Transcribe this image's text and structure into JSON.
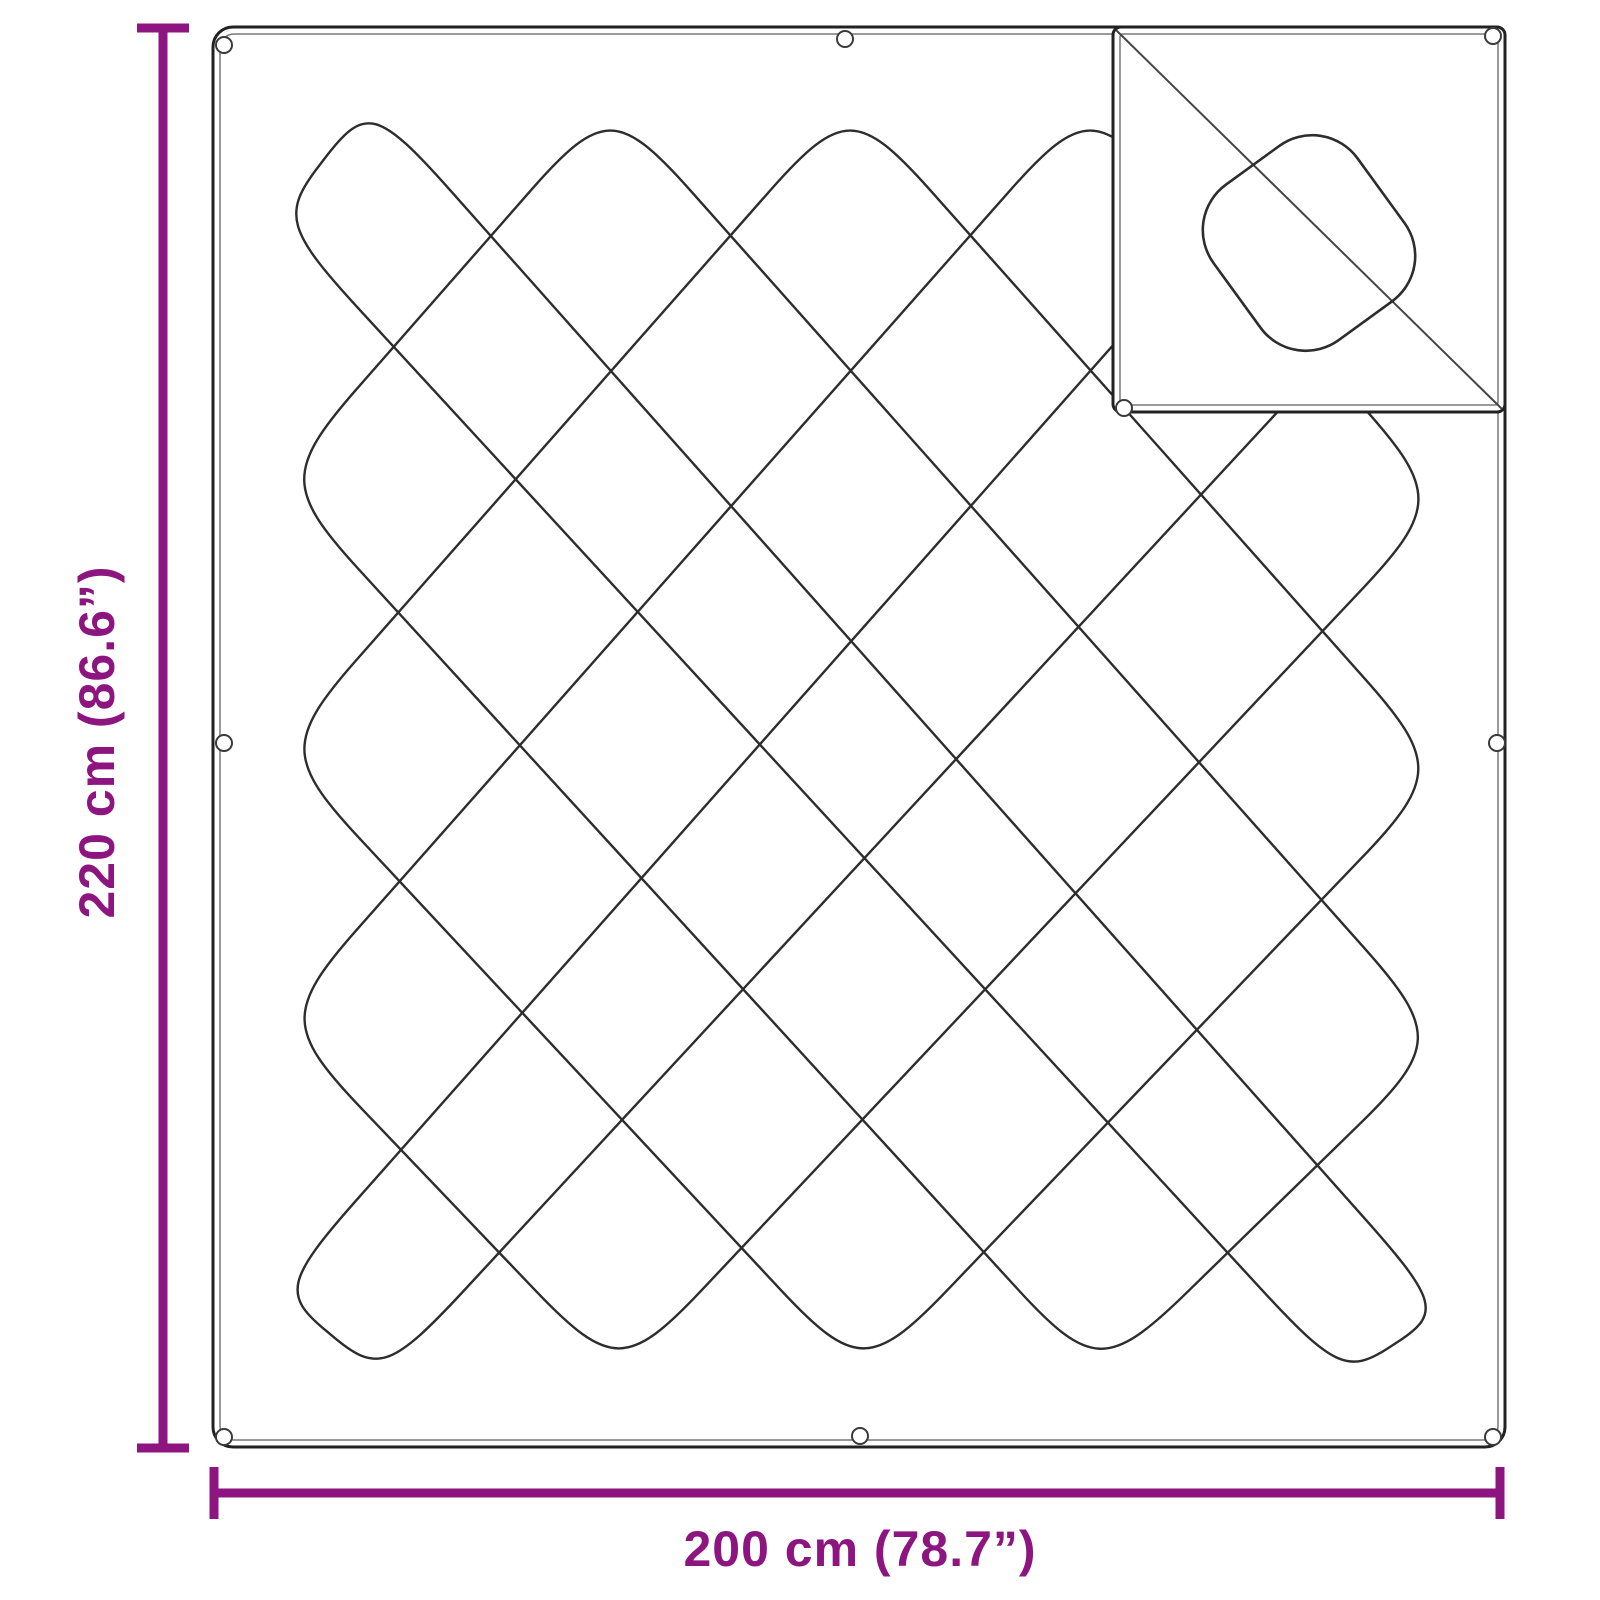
{
  "figure": {
    "background": "#ffffff",
    "description": "Quilted blanket dimension diagram with corner detail inset"
  },
  "dimensions": {
    "height_label": "220 cm (86.6”)",
    "width_label": "200 cm (78.7”)",
    "color": "#8D1580",
    "vertical_line": {
      "x": 163,
      "y1": 28,
      "y2": 1448,
      "label_x": 114,
      "label_y": 742
    },
    "horizontal_line": {
      "y": 1493,
      "x1": 214,
      "x2": 1500,
      "label_x": 860,
      "label_y": 1566
    },
    "line_thickness": 9,
    "cap_length": 52,
    "cap_thickness": 9
  },
  "blanket": {
    "outline_color": "#222222",
    "inner_line_color": "#787878",
    "pattern_color": "#2d2d2d",
    "grommet_color": "#3a3a3a",
    "rect": {
      "x": 213,
      "y": 27,
      "w": 1292,
      "h": 1420,
      "r": 20
    },
    "inner_inset": 7,
    "quilt_rings": [
      [
        [
          370,
          100
        ],
        [
          1446,
          1310
        ],
        [
          1343,
          1378
        ],
        [
          277,
          220
        ]
      ],
      [
        [
          610,
          100
        ],
        [
          1446,
          1040
        ],
        [
          1099,
          1378
        ],
        [
          277,
          480
        ]
      ],
      [
        [
          850,
          100
        ],
        [
          1446,
          770
        ],
        [
          863,
          1378
        ],
        [
          277,
          750
        ]
      ],
      [
        [
          1090,
          100
        ],
        [
          1446,
          500
        ],
        [
          619,
          1378
        ],
        [
          277,
          1020
        ]
      ],
      [
        [
          1330,
          100
        ],
        [
          1446,
          230
        ],
        [
          383,
          1378
        ],
        [
          277,
          1290
        ]
      ]
    ],
    "ring_corner_trim": 120,
    "ring_corner_tightness": 0.12,
    "grommets": [
      [
        224,
        45
      ],
      [
        845,
        39
      ],
      [
        224,
        743
      ],
      [
        1497,
        743
      ],
      [
        224,
        1437
      ],
      [
        860,
        1436
      ],
      [
        1493,
        1437
      ]
    ]
  },
  "inset": {
    "rect": {
      "x": 1113,
      "y": 27,
      "w": 392,
      "h": 385,
      "r": 8
    },
    "inner_inset": 7,
    "diagonal": {
      "x1": 1116,
      "y1": 30,
      "x2": 1502,
      "y2": 409
    },
    "motif": {
      "cx": 1309,
      "cy": 243,
      "w": 178,
      "h": 192,
      "r": 56,
      "angle": -36
    },
    "grommets": [
      [
        1124,
        408
      ],
      [
        1493,
        36
      ]
    ]
  }
}
